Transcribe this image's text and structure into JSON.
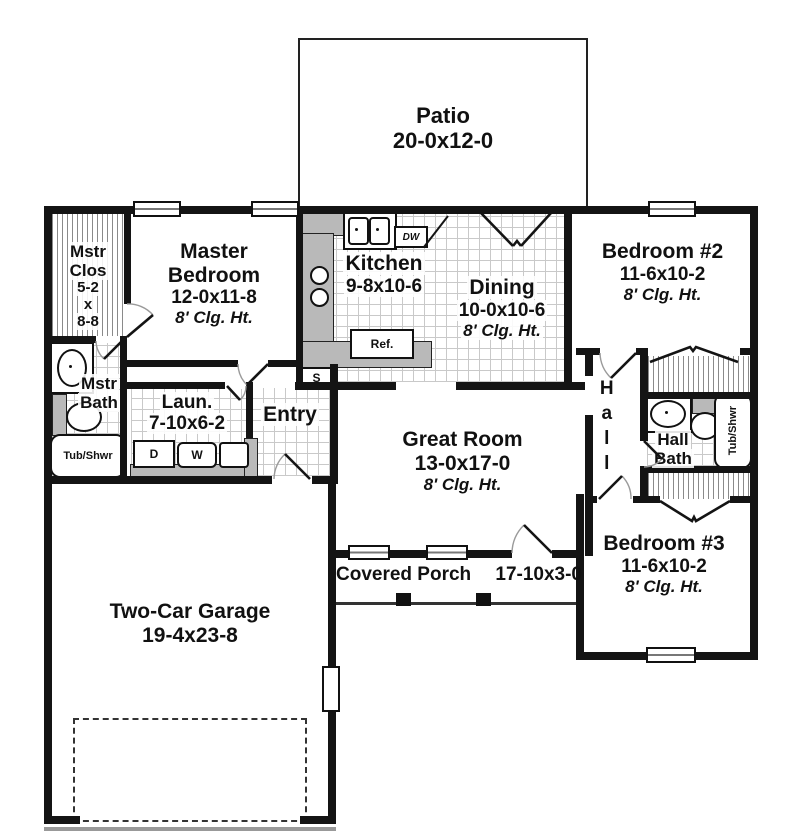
{
  "rooms": {
    "patio": {
      "name": "Patio",
      "dims": "20-0x12-0"
    },
    "master_closet": {
      "name1": "Mstr",
      "name2": "Clos",
      "d1": "5-2",
      "d2": "x",
      "d3": "8-8"
    },
    "master_bedroom": {
      "name1": "Master",
      "name2": "Bedroom",
      "dims": "12-0x11-8",
      "clg": "8' Clg. Ht."
    },
    "kitchen": {
      "name": "Kitchen",
      "dims": "9-8x10-6"
    },
    "dining": {
      "name": "Dining",
      "dims": "10-0x10-6",
      "clg": "8' Clg. Ht."
    },
    "bedroom2": {
      "name": "Bedroom #2",
      "dims": "11-6x10-2",
      "clg": "8' Clg. Ht."
    },
    "master_bath": {
      "name1": "Mstr",
      "name2": "Bath"
    },
    "laundry": {
      "name": "Laun.",
      "dims": "7-10x6-2"
    },
    "entry": {
      "name": "Entry"
    },
    "great_room": {
      "name": "Great Room",
      "dims": "13-0x17-0",
      "clg": "8' Clg. Ht."
    },
    "hall": {
      "name": "Hall"
    },
    "hall_bath": {
      "name1": "Hall",
      "name2": "Bath"
    },
    "bedroom3": {
      "name": "Bedroom #3",
      "dims": "11-6x10-2",
      "clg": "8' Clg. Ht."
    },
    "covered_porch": {
      "name": "Covered Porch",
      "dims": "17-10x3-0"
    },
    "garage": {
      "name": "Two-Car Garage",
      "dims": "19-4x23-8"
    }
  },
  "fixtures": {
    "dishwasher": "DW",
    "refrigerator": "Ref.",
    "dryer": "D",
    "washer": "W",
    "shelves": "S",
    "master_tub": "Tub/Shwr",
    "hall_tub": "Tub/Shwr"
  },
  "colors": {
    "wall": "#141414",
    "counter": "#b9b9b9",
    "tile_line": "#c9c9c9",
    "hatch_line": "#8a8a8a"
  }
}
